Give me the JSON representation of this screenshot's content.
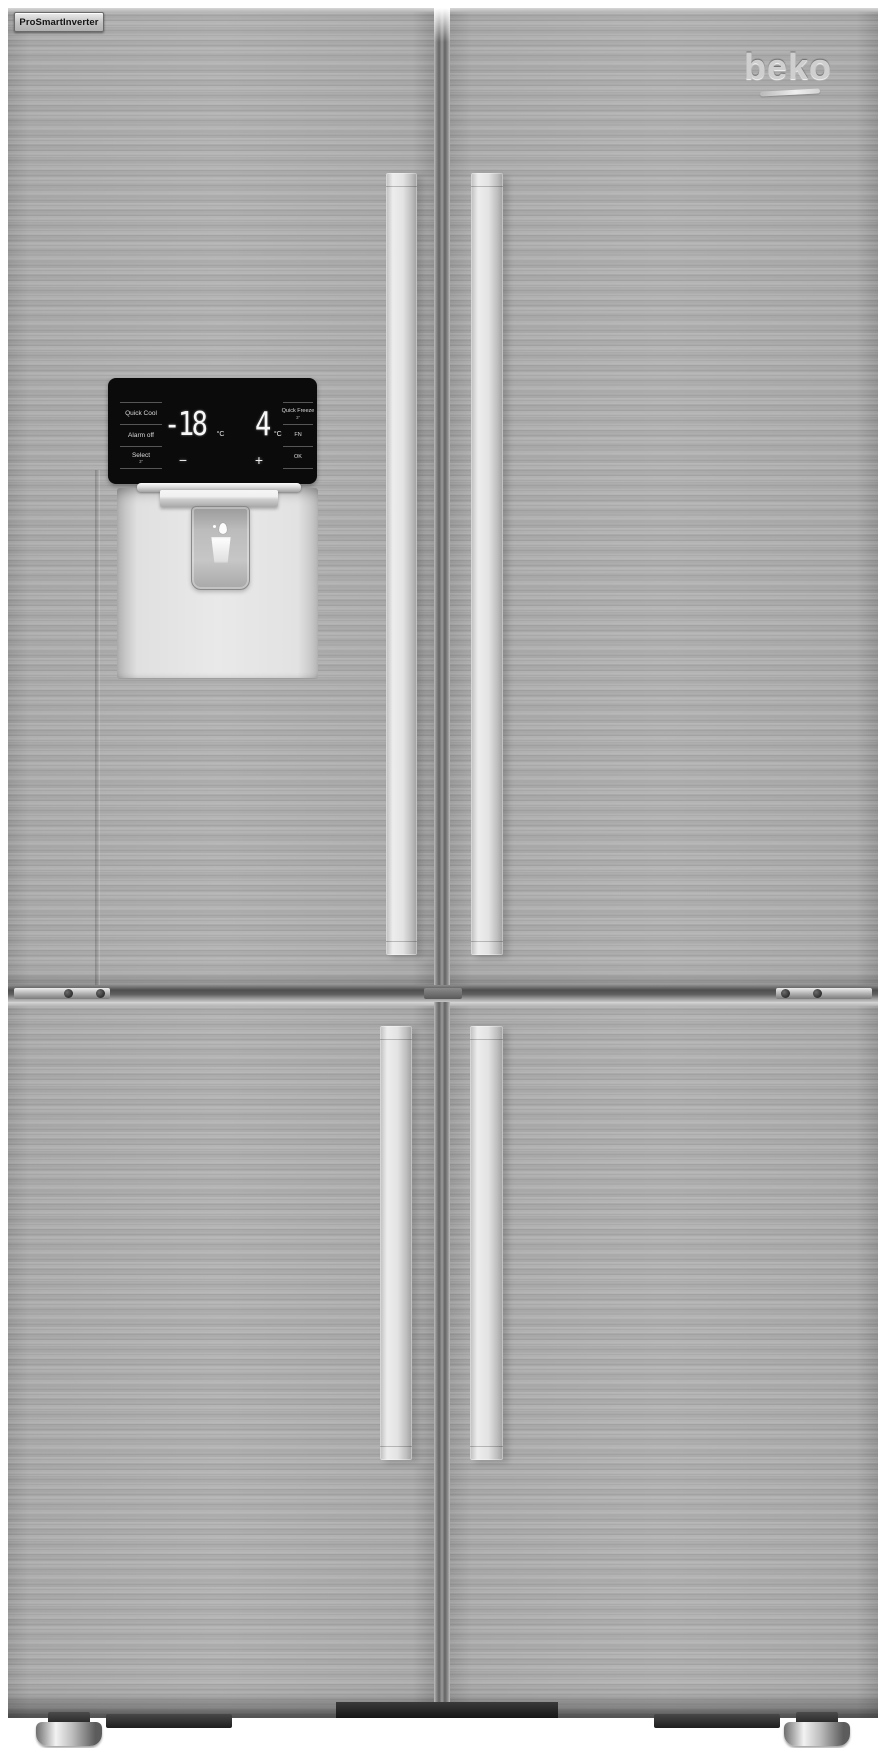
{
  "badge": {
    "label": "ProSmartInverter"
  },
  "brand": {
    "logo_text": "beko"
  },
  "control_panel": {
    "left_buttons": [
      {
        "label": "Quick Cool"
      },
      {
        "label": "Alarm off"
      },
      {
        "label": "Select",
        "sublabel": "3″"
      }
    ],
    "right_buttons": [
      {
        "label": "Quick Freeze",
        "sublabel": "3″"
      },
      {
        "label": "FN"
      },
      {
        "label": "OK"
      }
    ],
    "freezer_display": {
      "value": "-18",
      "unit": "°C"
    },
    "fridge_display": {
      "value": "4",
      "unit": "°C"
    },
    "decrease_label": "−",
    "increase_label": "+"
  },
  "icons": {
    "dispenser": "water-glass-icon",
    "droplet": "water-droplet-icon"
  },
  "colors": {
    "door_steel": "#ababab",
    "handle": "#e0e0e0",
    "panel_black": "#0b0b0b",
    "display_text": "#f7f7f7",
    "recess": "#e9e9e9",
    "background": "#ffffff"
  }
}
